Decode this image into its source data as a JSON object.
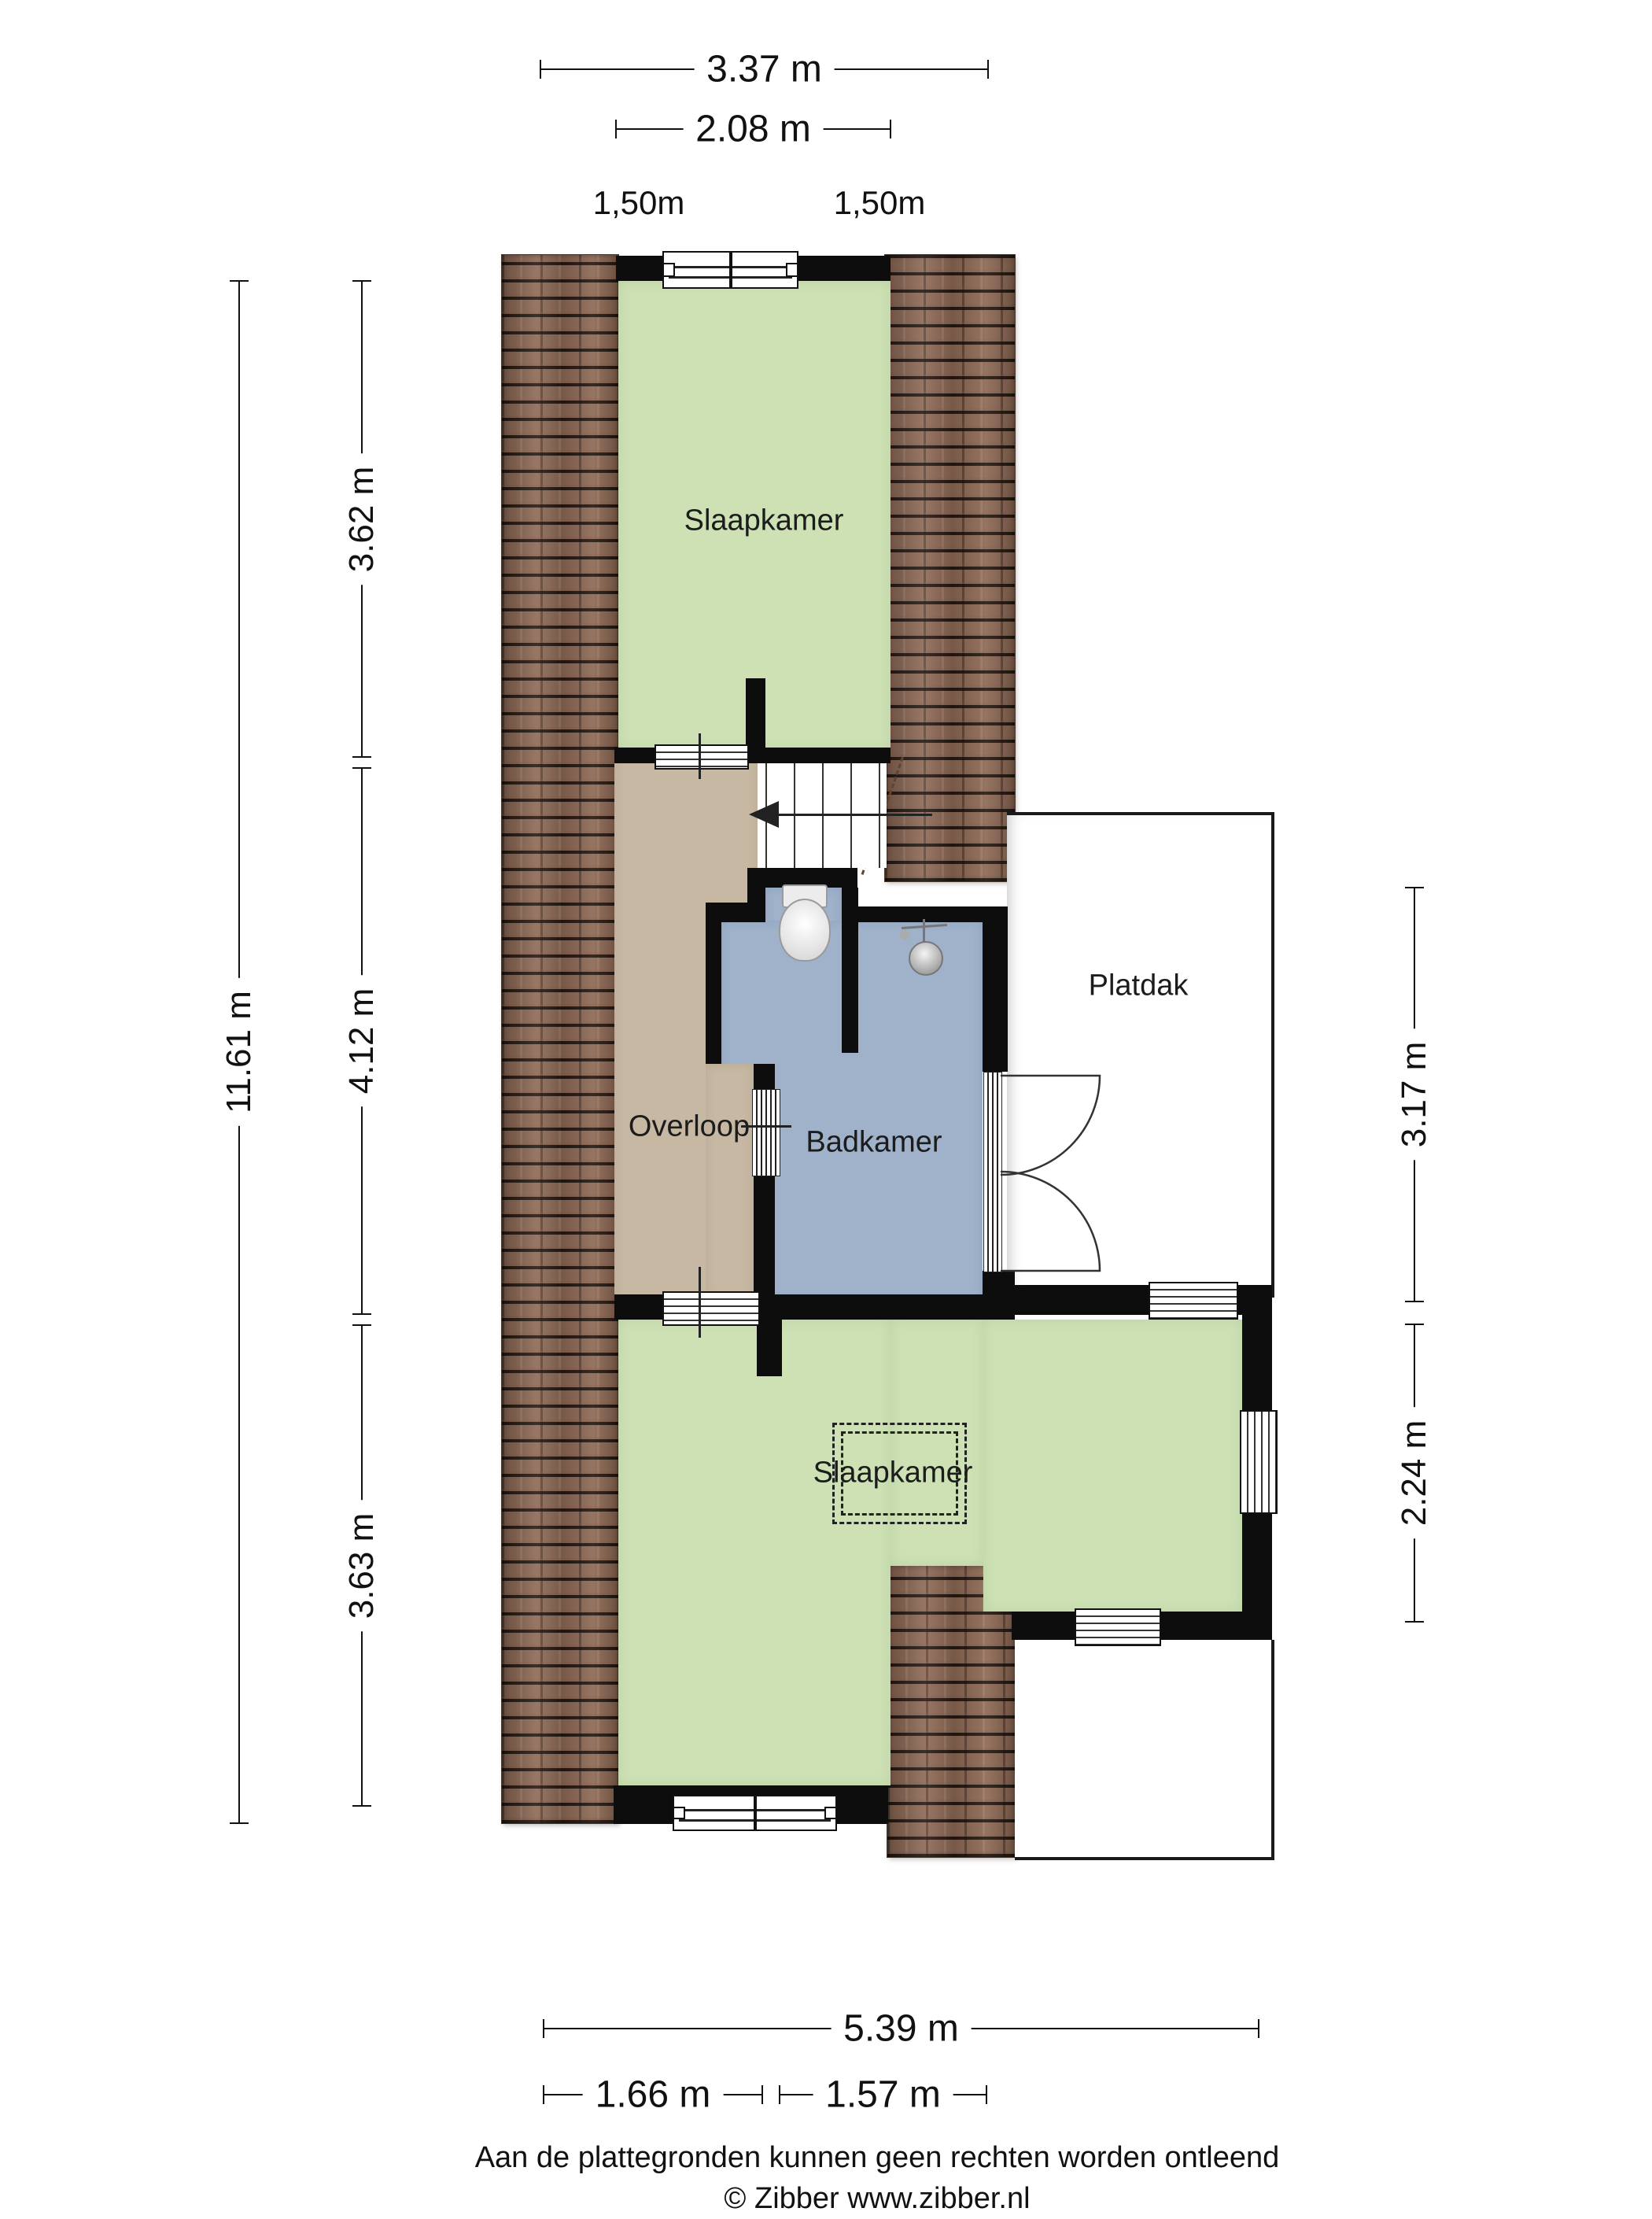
{
  "plan": {
    "type": "floorplan",
    "floor": "upper",
    "rooms": [
      {
        "id": "slaapkamer-top",
        "label": "Slaapkamer",
        "fill": "#cde1b5"
      },
      {
        "id": "overloop",
        "label": "Overloop",
        "fill": "#c7b8a3"
      },
      {
        "id": "badkamer",
        "label": "Badkamer",
        "fill": "#9fb2ca"
      },
      {
        "id": "platdak",
        "label": "Platdak",
        "fill": "#ffffff"
      },
      {
        "id": "slaapkamer-bottom",
        "label": "Slaapkamer",
        "fill": "#cde1b5"
      }
    ],
    "icons": [
      "toilet-icon",
      "shower-icon",
      "stairs-direction-arrow-icon",
      "roof-edge-dashed-line"
    ],
    "colors": {
      "wall": "#0d0d0d",
      "roof": "#8d6854",
      "green": "#cde1b5",
      "tan": "#c7b8a3",
      "blue": "#9fb2ca"
    }
  },
  "labels": {
    "slaapkamer_top": "Slaapkamer",
    "overloop": "Overloop",
    "badkamer": "Badkamer",
    "platdak": "Platdak",
    "slaapkamer_bottom": "Slaapkamer",
    "dim_total_width_top": "3.37 m",
    "dim_room_width_top": "2.08 m",
    "dim_knee_left": "1,50m",
    "dim_knee_right": "1,50m",
    "dim_total_height": "11.61 m",
    "dim_section_top": "3.62 m",
    "dim_section_mid": "4.12 m",
    "dim_section_bottom": "3.63 m",
    "dim_platdak_height": "3.17 m",
    "dim_extension_height": "2.24 m",
    "dim_total_width_bottom": "5.39 m",
    "dim_bottom_left": "1.66 m",
    "dim_bottom_right": "1.57 m",
    "footer_disclaimer": "Aan de plattegronden kunnen geen rechten worden ontleend",
    "footer_credit": "© Zibber www.zibber.nl"
  }
}
